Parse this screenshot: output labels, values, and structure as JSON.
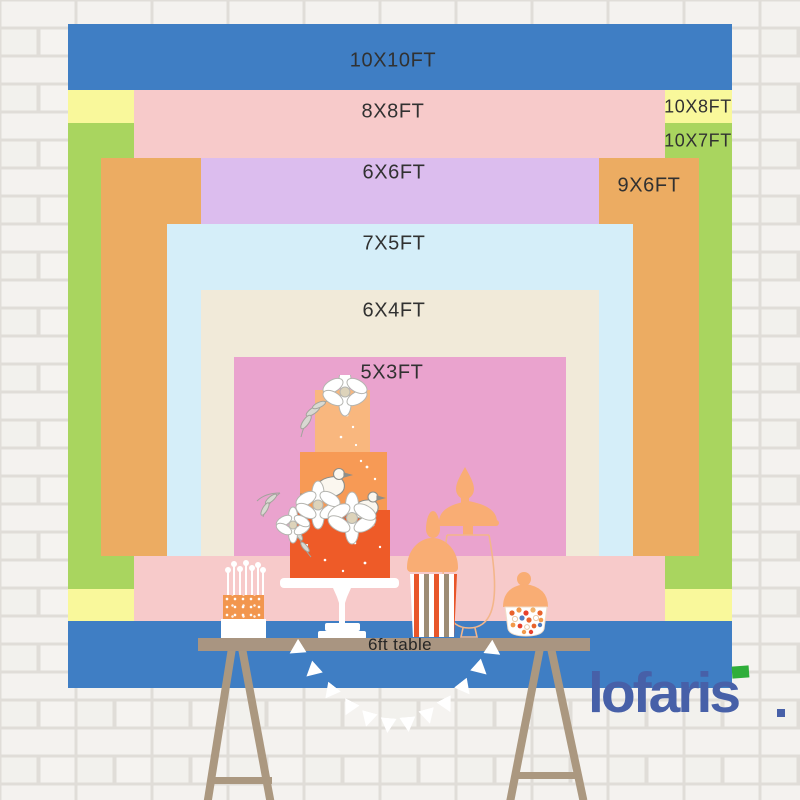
{
  "backdrop": {
    "sizes": [
      {
        "label": "10X10FT",
        "color": "#3f7ec4"
      },
      {
        "label": "10X8FT",
        "color": "#f9f89b"
      },
      {
        "label": "10X7FT",
        "color": "#a9d55f"
      },
      {
        "label": "8X8FT",
        "color": "#f7caca"
      },
      {
        "label": "9X6FT",
        "color": "#ecac62"
      },
      {
        "label": "6X6FT",
        "color": "#dcbdee"
      },
      {
        "label": "7X5FT",
        "color": "#d5eef9"
      },
      {
        "label": "6X4FT",
        "color": "#f1ead9"
      },
      {
        "label": "5X3FT",
        "color": "#eaa3ce"
      }
    ]
  },
  "table": {
    "label": "6ft table",
    "surface_color": "#a99581",
    "leg_color": "#ab9880"
  },
  "brand": {
    "name": "lofaris",
    "text_color": "#4760a8",
    "accent_color": "#2fae3a"
  },
  "wall": {
    "brick_color": "#f3f1ed",
    "mortar_color": "#dcd9d3"
  },
  "decor": {
    "items": [
      "tiered-cake",
      "mini-cake-with-candles",
      "popcorn-box",
      "apothecary-jar",
      "candy-jar",
      "pennant-banner",
      "trestle-table"
    ]
  }
}
